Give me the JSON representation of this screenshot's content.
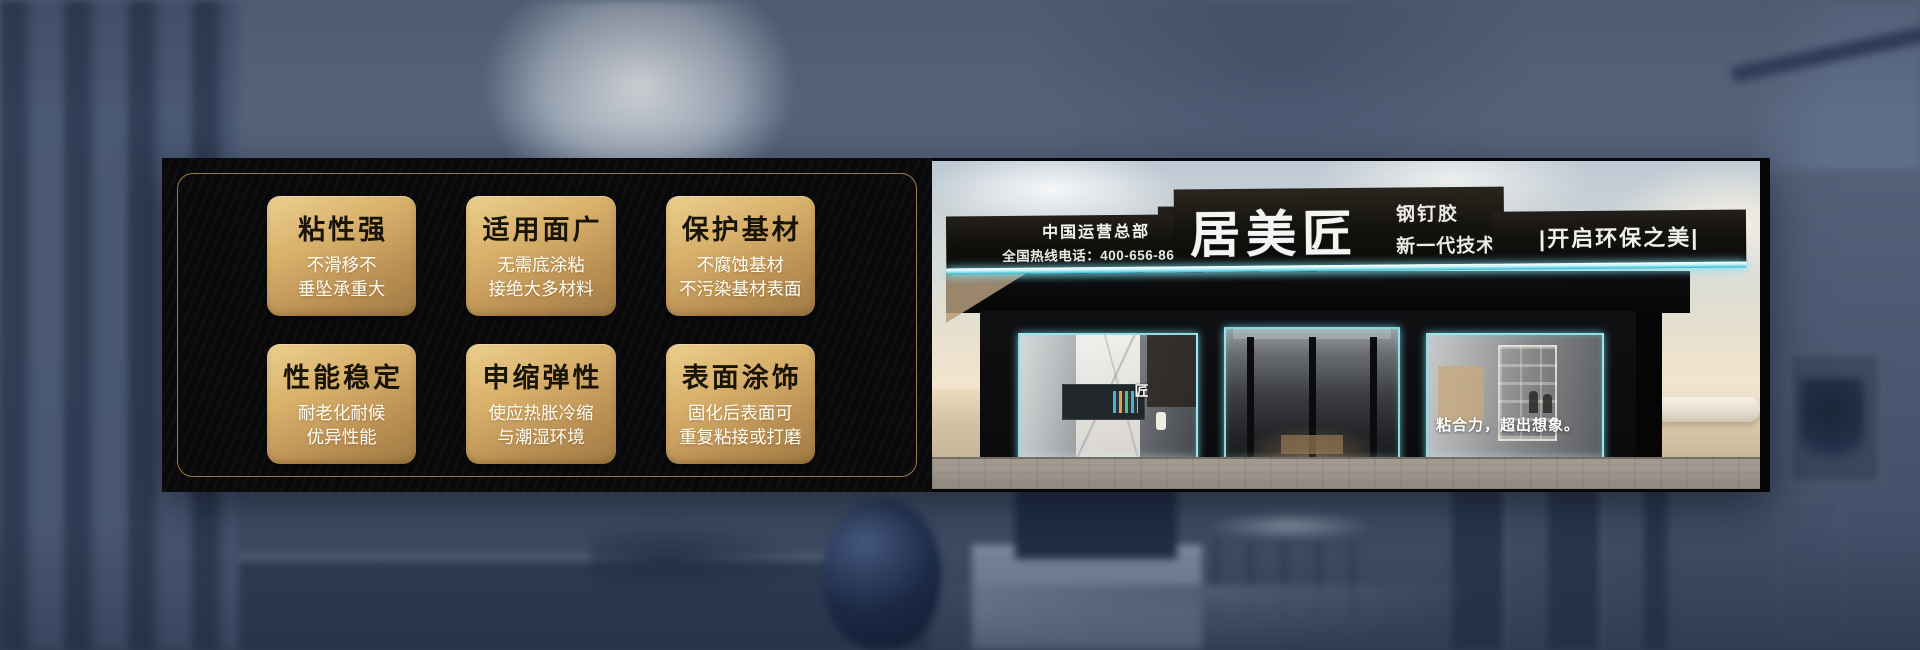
{
  "panel": {
    "features": [
      {
        "title": "粘性强",
        "lines": [
          "不滑移不",
          "垂坠承重大"
        ]
      },
      {
        "title": "适用面广",
        "lines": [
          "无需底涂粘",
          "接绝大多材料"
        ]
      },
      {
        "title": "保护基材",
        "lines": [
          "不腐蚀基材",
          "不污染基材表面"
        ]
      },
      {
        "title": "性能稳定",
        "lines": [
          "耐老化耐候",
          "优异性能"
        ]
      },
      {
        "title": "申缩弹性",
        "lines": [
          "使应热胀冷缩",
          "与潮湿环境"
        ]
      },
      {
        "title": "表面涂饰",
        "lines": [
          "固化后表面可",
          "重复粘接或打磨"
        ]
      }
    ]
  },
  "storefront": {
    "hq": "中国运营总部",
    "hotline": "全国热线电话：400-656-8678",
    "brand": "居美匠",
    "product": "钢钉胶",
    "generation": "新一代技术",
    "right_slogan": "|开启环保之美|",
    "glass_slogan": "粘合力，超出想象。",
    "glass_logo": "匠"
  },
  "colors": {
    "card_gold_light": "#ecd08f",
    "card_gold_dark": "#9e7a43",
    "panel_frame_gold": "#9c7a46",
    "led_cyan": "#9fe8f2",
    "background_slate": "#4d5b74",
    "banner_black": "#0a0a0c"
  }
}
